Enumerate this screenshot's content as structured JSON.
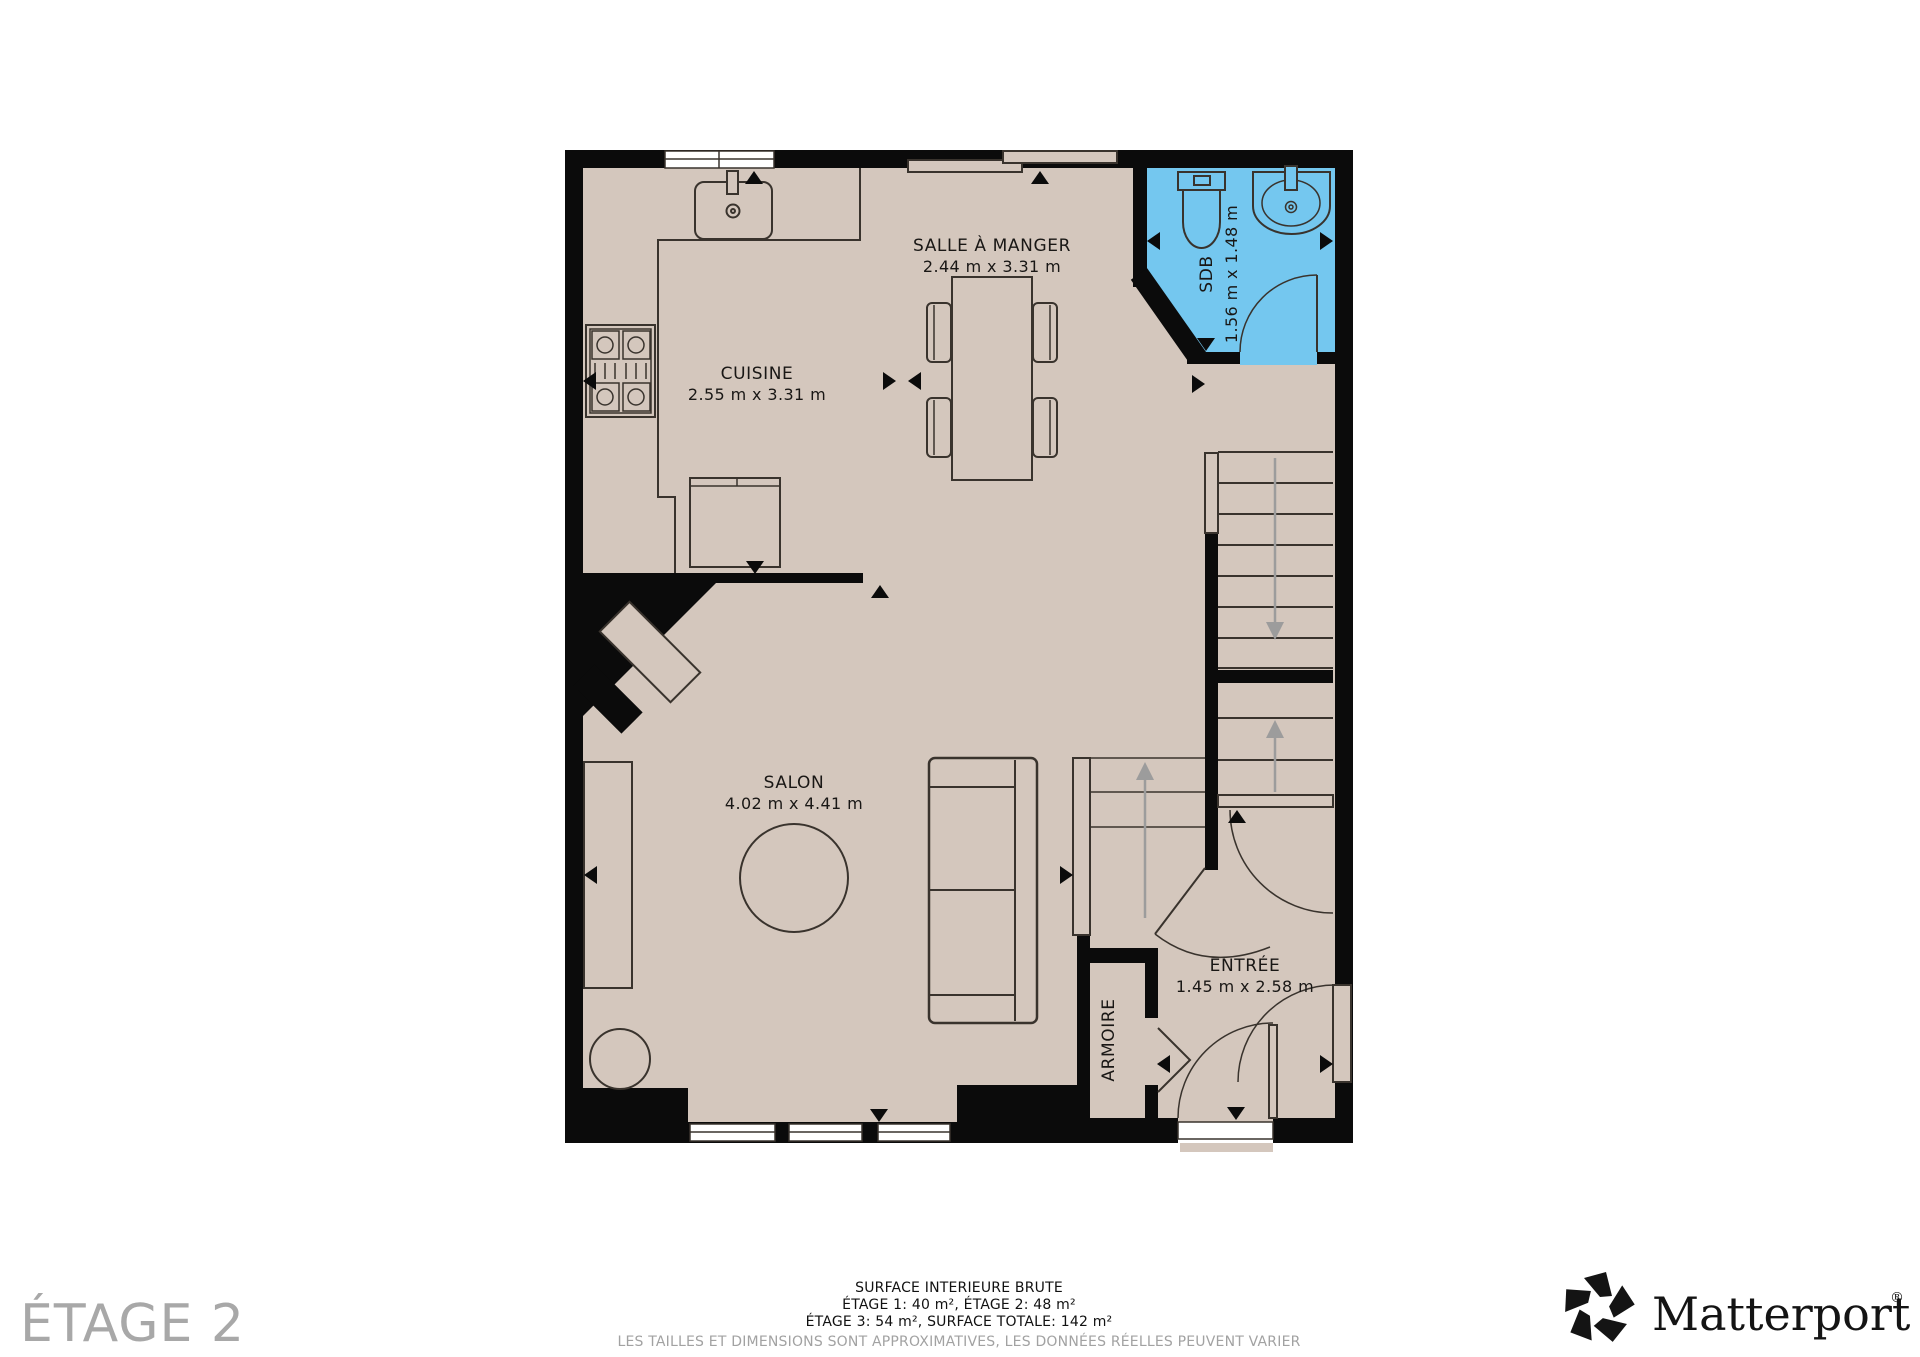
{
  "floor_plan": {
    "floor_label": "ÉTAGE 2",
    "rooms": [
      {
        "id": "salle_a_manger",
        "name": "SALLE À MANGER",
        "dims": "2.44 m x 3.31 m"
      },
      {
        "id": "cuisine",
        "name": "CUISINE",
        "dims": "2.55 m x 3.31 m"
      },
      {
        "id": "sdb",
        "name": "SDB",
        "dims": "1.56 m x 1.48 m"
      },
      {
        "id": "salon",
        "name": "SALON",
        "dims": "4.02 m x 4.41 m"
      },
      {
        "id": "entree",
        "name": "ENTRÉE",
        "dims": "1.45 m x 2.58 m"
      },
      {
        "id": "armoire",
        "name": "ARMOIRE"
      }
    ]
  },
  "footer": {
    "line1": "SURFACE INTERIEURE BRUTE",
    "line2": "ÉTAGE 1: 40 m², ÉTAGE 2: 48 m²",
    "line3": "ÉTAGE 3: 54 m², SURFACE TOTALE: 142 m²",
    "disclaimer": "LES TAILLES ET DIMENSIONS SONT APPROXIMATIVES, LES DONNÉES RÉELLES PEUVENT VARIER"
  },
  "brand": {
    "name": "Matterport",
    "registered": "®"
  },
  "colors": {
    "floor": "#d4c7bd",
    "highlight": "#74c7ef",
    "wall": "#0b0b0b",
    "line": "#39332d",
    "arrow_gray": "#9c9c9c",
    "label_gray": "#a8a8a8",
    "disclaimer_gray": "#a2a2a2"
  }
}
